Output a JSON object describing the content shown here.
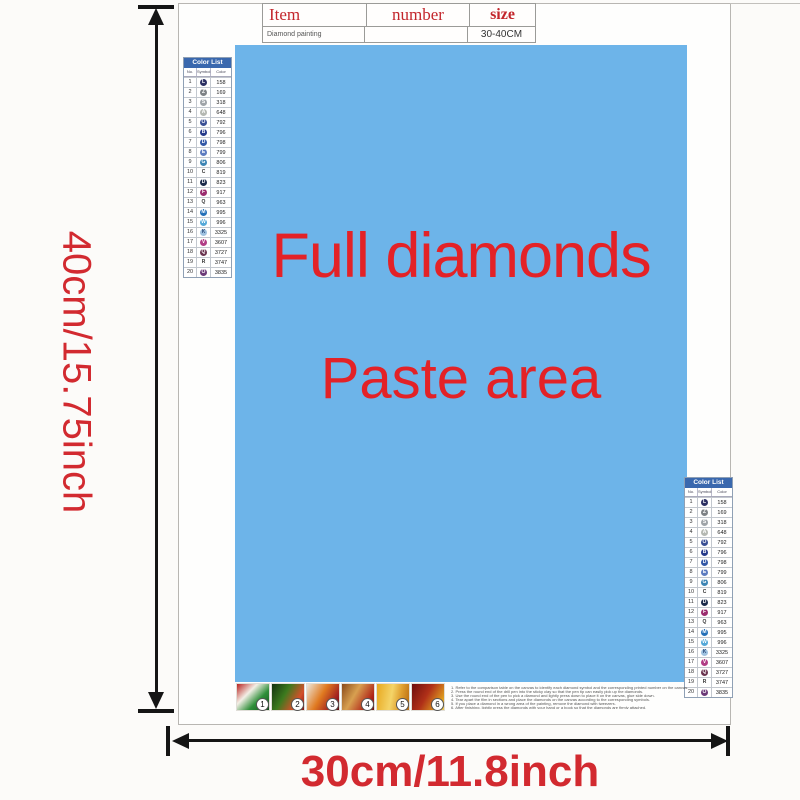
{
  "colors": {
    "paste_blue": "#6db4e9",
    "paste_text_red": "#e32227",
    "accent_red": "#d22a30",
    "list_header_blue": "#3a68ae"
  },
  "info_table": {
    "headers": [
      "Item",
      "number",
      "size"
    ],
    "row": {
      "item": "Diamond painting",
      "number": "",
      "size": "30-40CM"
    }
  },
  "paste_area": {
    "line1": "Full diamonds",
    "line2": "Paste area"
  },
  "dimensions": {
    "height_label": "40cm/15.75inch",
    "width_label": "30cm/11.8inch"
  },
  "color_list": {
    "title": "Color List",
    "columns": [
      "No.",
      "Symbol",
      "Color"
    ],
    "rows": [
      {
        "no": "1",
        "letter": "L",
        "bg": "#2c3063",
        "fg": "#ffffff",
        "code": "158"
      },
      {
        "no": "2",
        "letter": "Z",
        "bg": "#7e8286",
        "fg": "#ffffff",
        "code": "169"
      },
      {
        "no": "3",
        "letter": "S",
        "bg": "#9fa4a8",
        "fg": "#ffffff",
        "code": "318"
      },
      {
        "no": "4",
        "letter": "A",
        "bg": "#b4b8b2",
        "fg": "#ffffff",
        "code": "648"
      },
      {
        "no": "5",
        "letter": "O",
        "bg": "#3a4f94",
        "fg": "#ffffff",
        "code": "792"
      },
      {
        "no": "6",
        "letter": "B",
        "bg": "#263a8a",
        "fg": "#ffffff",
        "code": "796"
      },
      {
        "no": "7",
        "letter": "D",
        "bg": "#3358a6",
        "fg": "#ffffff",
        "code": "798"
      },
      {
        "no": "8",
        "letter": "E",
        "bg": "#5d7cc0",
        "fg": "#ffffff",
        "code": "799"
      },
      {
        "no": "9",
        "letter": "G",
        "bg": "#3d85b4",
        "fg": "#ffffff",
        "code": "806"
      },
      {
        "no": "10",
        "letter": "C",
        "bg": "",
        "fg": "#333333",
        "code": "819"
      },
      {
        "no": "11",
        "letter": "D",
        "bg": "#1b2a4a",
        "fg": "#ffffff",
        "code": "823"
      },
      {
        "no": "12",
        "letter": "F",
        "bg": "#9b2d6f",
        "fg": "#ffffff",
        "code": "917"
      },
      {
        "no": "13",
        "letter": "Q",
        "bg": "",
        "fg": "#333333",
        "code": "963"
      },
      {
        "no": "14",
        "letter": "M",
        "bg": "#2470b8",
        "fg": "#ffffff",
        "code": "995"
      },
      {
        "no": "15",
        "letter": "W",
        "bg": "#54a8d8",
        "fg": "#ffffff",
        "code": "996"
      },
      {
        "no": "16",
        "letter": "K",
        "bg": "#9fc2e0",
        "fg": "#2a4a7a",
        "code": "3325"
      },
      {
        "no": "17",
        "letter": "V",
        "bg": "#b13d85",
        "fg": "#ffffff",
        "code": "3607"
      },
      {
        "no": "18",
        "letter": "Q",
        "bg": "#6b3550",
        "fg": "#ffffff",
        "code": "3727"
      },
      {
        "no": "19",
        "letter": "R",
        "bg": "",
        "fg": "#333333",
        "code": "3747"
      },
      {
        "no": "20",
        "letter": "O",
        "bg": "#6b3a78",
        "fg": "#ffffff",
        "code": "3835"
      }
    ]
  },
  "steps": [
    "1",
    "2",
    "3",
    "4",
    "5",
    "6"
  ],
  "instructions": [
    "1. Refer to the comparison table on the canvas to identify each diamond symbol and the corresponding printed number on the canvas.",
    "2. Press the round end of the drill pen into the sticky clay so that the pen tip can easily pick up the diamonds.",
    "3. Use the round end of the pen to pick a diamond and lightly press down to place it on the canvas, glue side down.",
    "4. Tear apart the film in sections and place the diamonds on the canvas according to the corresponding symbols.",
    "5. If you place a diamond in a wrong area of the painting, remove the diamond with tweezers.",
    "6. After finishing, lightly press the diamonds with your hand or a book so that the diamonds are firmly attached."
  ]
}
